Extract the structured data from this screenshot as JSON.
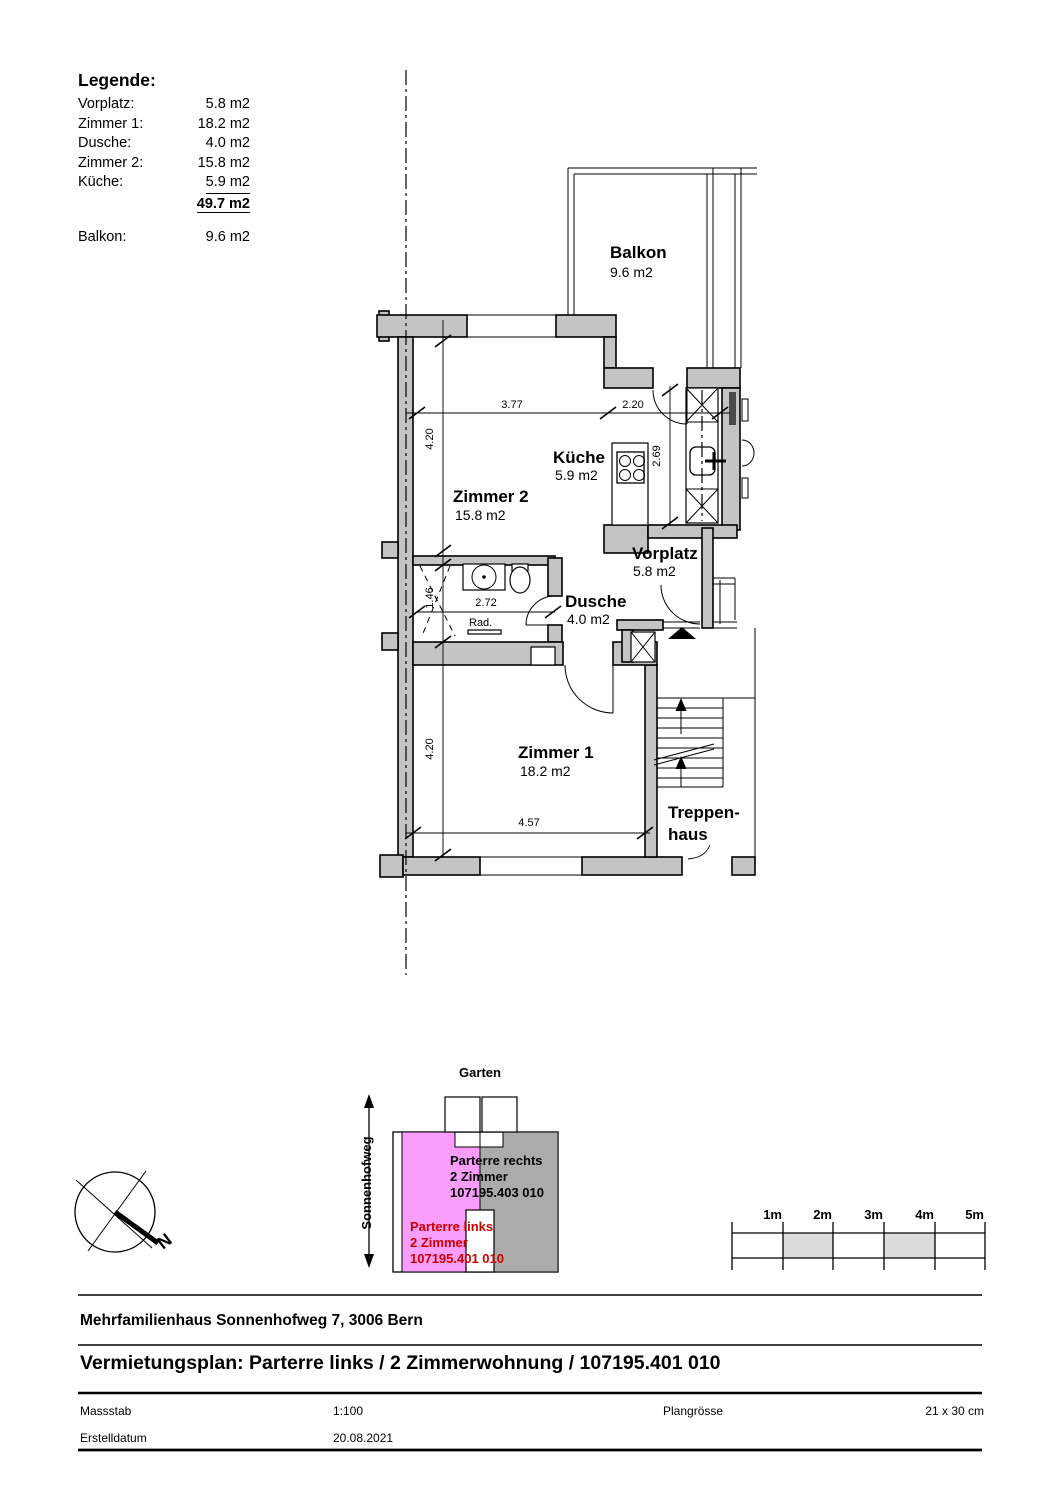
{
  "legend": {
    "title": "Legende:",
    "rows": [
      {
        "label": "Vorplatz:",
        "value": "5.8 m2"
      },
      {
        "label": "Zimmer 1:",
        "value": "18.2 m2"
      },
      {
        "label": "Dusche:",
        "value": "4.0 m2"
      },
      {
        "label": "Zimmer 2:",
        "value": "15.8 m2"
      },
      {
        "label": "Küche:",
        "value": "5.9 m2"
      }
    ],
    "total": "49.7 m2",
    "balcony": {
      "label": "Balkon:",
      "value": "9.6 m2"
    }
  },
  "plan": {
    "rooms": {
      "balkon": {
        "name": "Balkon",
        "area": "9.6 m2"
      },
      "zimmer2": {
        "name": "Zimmer 2",
        "area": "15.8 m2"
      },
      "kueche": {
        "name": "Küche",
        "area": "5.9 m2"
      },
      "vorplatz": {
        "name": "Vorplatz",
        "area": "5.8 m2"
      },
      "dusche": {
        "name": "Dusche",
        "area": "4.0 m2"
      },
      "zimmer1": {
        "name": "Zimmer 1",
        "area": "18.2 m2"
      }
    },
    "stairwell": {
      "line1": "Treppen-",
      "line2": "haus"
    },
    "radiator": "Rad.",
    "dims": {
      "zimmer2_width": "3.77",
      "kueche_width": "2.20",
      "zimmer2_depth": "4.20",
      "kueche_depth": "2.69",
      "dusche_width": "2.72",
      "dusche_depth": "1.46",
      "zimmer1_depth": "4.20",
      "zimmer1_width": "4.57"
    }
  },
  "siteplan": {
    "garden": "Garten",
    "street": "Sonnenhofweg",
    "north": "N",
    "unit_right": {
      "line1": "Parterre rechts",
      "line2": "2 Zimmer",
      "line3": "107195.403 010"
    },
    "unit_left": {
      "line1": "Parterre links",
      "line2": "2 Zimmer",
      "line3": "107195.401 010"
    }
  },
  "scalebar": {
    "labels": [
      "1m",
      "2m",
      "3m",
      "4m",
      "5m"
    ]
  },
  "titleblock": {
    "building": "Mehrfamilienhaus Sonnenhofweg 7, 3006 Bern",
    "title": "Vermietungsplan: Parterre links / 2 Zimmerwohnung / 107195.401 010",
    "scale_label": "Massstab",
    "scale_value": "1:100",
    "size_label": "Plangrösse",
    "size_value": "21 x 30 cm",
    "date_label": "Erstelldatum",
    "date_value": "20.08.2021"
  },
  "colors": {
    "wall": "#c4c4c4",
    "unit_highlight": "#fb9dfb",
    "unit_neighbor": "#ababab",
    "unit_text_red": "#cc0000",
    "scalebar_gray": "#dcdcdc"
  }
}
